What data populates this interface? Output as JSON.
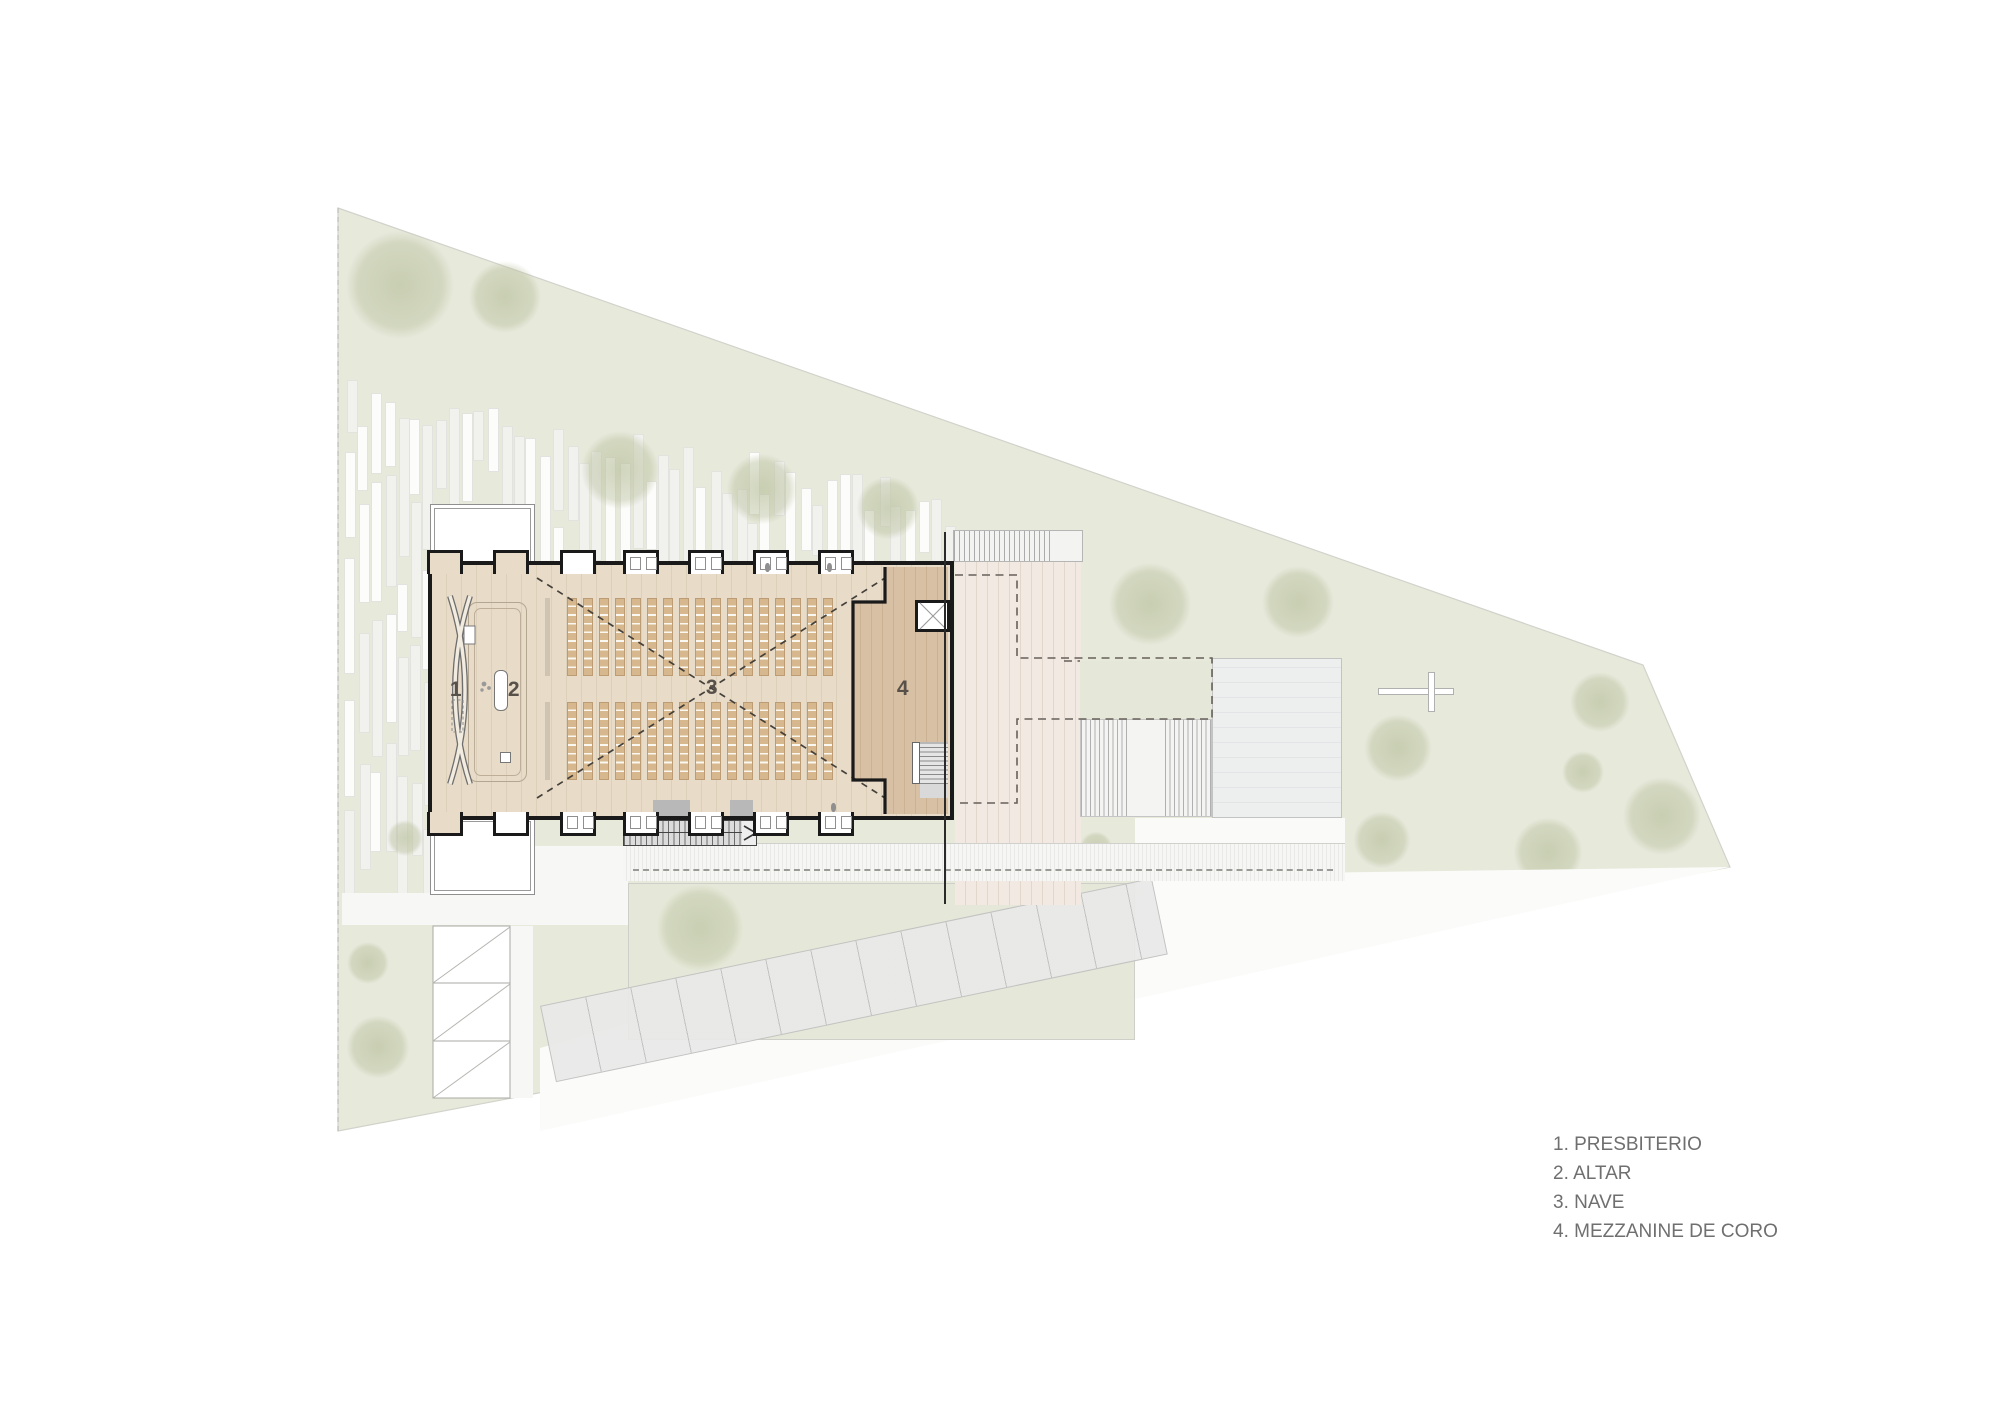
{
  "title": "Church floor plan",
  "legend": {
    "items": [
      "1. PRESBITERIO",
      "2. ALTAR",
      "3. NAVE",
      "4. MEZZANINE DE CORO"
    ]
  },
  "plan": {
    "labels": [
      {
        "text": "1",
        "x": 456,
        "y": 690
      },
      {
        "text": "2",
        "x": 514,
        "y": 690
      },
      {
        "text": "3",
        "x": 712,
        "y": 688
      },
      {
        "text": "4",
        "x": 903,
        "y": 689
      }
    ],
    "buttresses": {
      "xs": [
        445,
        511,
        578,
        641,
        706,
        771,
        836
      ],
      "top": [
        [
          "tan",
          0
        ],
        [
          "tan",
          0
        ],
        [
          "white",
          0
        ],
        [
          "white",
          2
        ],
        [
          "white",
          2
        ],
        [
          "white",
          2
        ],
        [
          "white",
          2
        ]
      ],
      "bottom": [
        [
          "tan",
          0
        ],
        [
          "white",
          0
        ],
        [
          "white",
          2
        ],
        [
          "white",
          2
        ],
        [
          "white",
          2
        ],
        [
          "white",
          2
        ],
        [
          "white",
          2
        ]
      ],
      "figures_top": [
        765,
        827
      ],
      "figures_bottom": [
        831
      ]
    },
    "pews": {
      "columns": 17,
      "blocks": [
        {
          "x": 567,
          "y": 598,
          "w": 266,
          "h": 78
        },
        {
          "x": 567,
          "y": 702,
          "w": 266,
          "h": 78
        }
      ]
    }
  },
  "features": {
    "trees": [
      [
        400,
        285,
        72
      ],
      [
        505,
        297,
        48
      ],
      [
        620,
        470,
        52
      ],
      [
        762,
        489,
        47
      ],
      [
        888,
        508,
        42
      ],
      [
        1150,
        604,
        55
      ],
      [
        1298,
        602,
        48
      ],
      [
        1398,
        748,
        45
      ],
      [
        1382,
        840,
        38
      ],
      [
        1600,
        702,
        40
      ],
      [
        1662,
        816,
        52
      ],
      [
        1548,
        852,
        46
      ],
      [
        1583,
        772,
        28
      ],
      [
        700,
        928,
        58
      ],
      [
        405,
        838,
        24
      ],
      [
        368,
        963,
        28
      ],
      [
        378,
        1047,
        42
      ],
      [
        1096,
        848,
        22
      ]
    ],
    "stripes": {
      "seed": 7,
      "x0": 345,
      "x1": 1168,
      "pitch": 13,
      "bar_w": 9
    }
  },
  "colors": {
    "site_green": "#e7e9db",
    "courtyard_green": "#e5e8d8",
    "tree_green": "#b8c09c",
    "floor": "#e8dcc9",
    "floor_line": "#ddd0bb",
    "mezzanine": "#d8c0a5",
    "pew": "#d7b78d",
    "wall": "#1a1a1a",
    "deck": "#f2eae2",
    "plaza": "#edeeee",
    "path_white": "#f7f7f6",
    "dash": "#66605a",
    "legend_text": "#6f6f6f",
    "number_text": "#57514a"
  },
  "icons": {
    "cross": "cross-icon"
  }
}
